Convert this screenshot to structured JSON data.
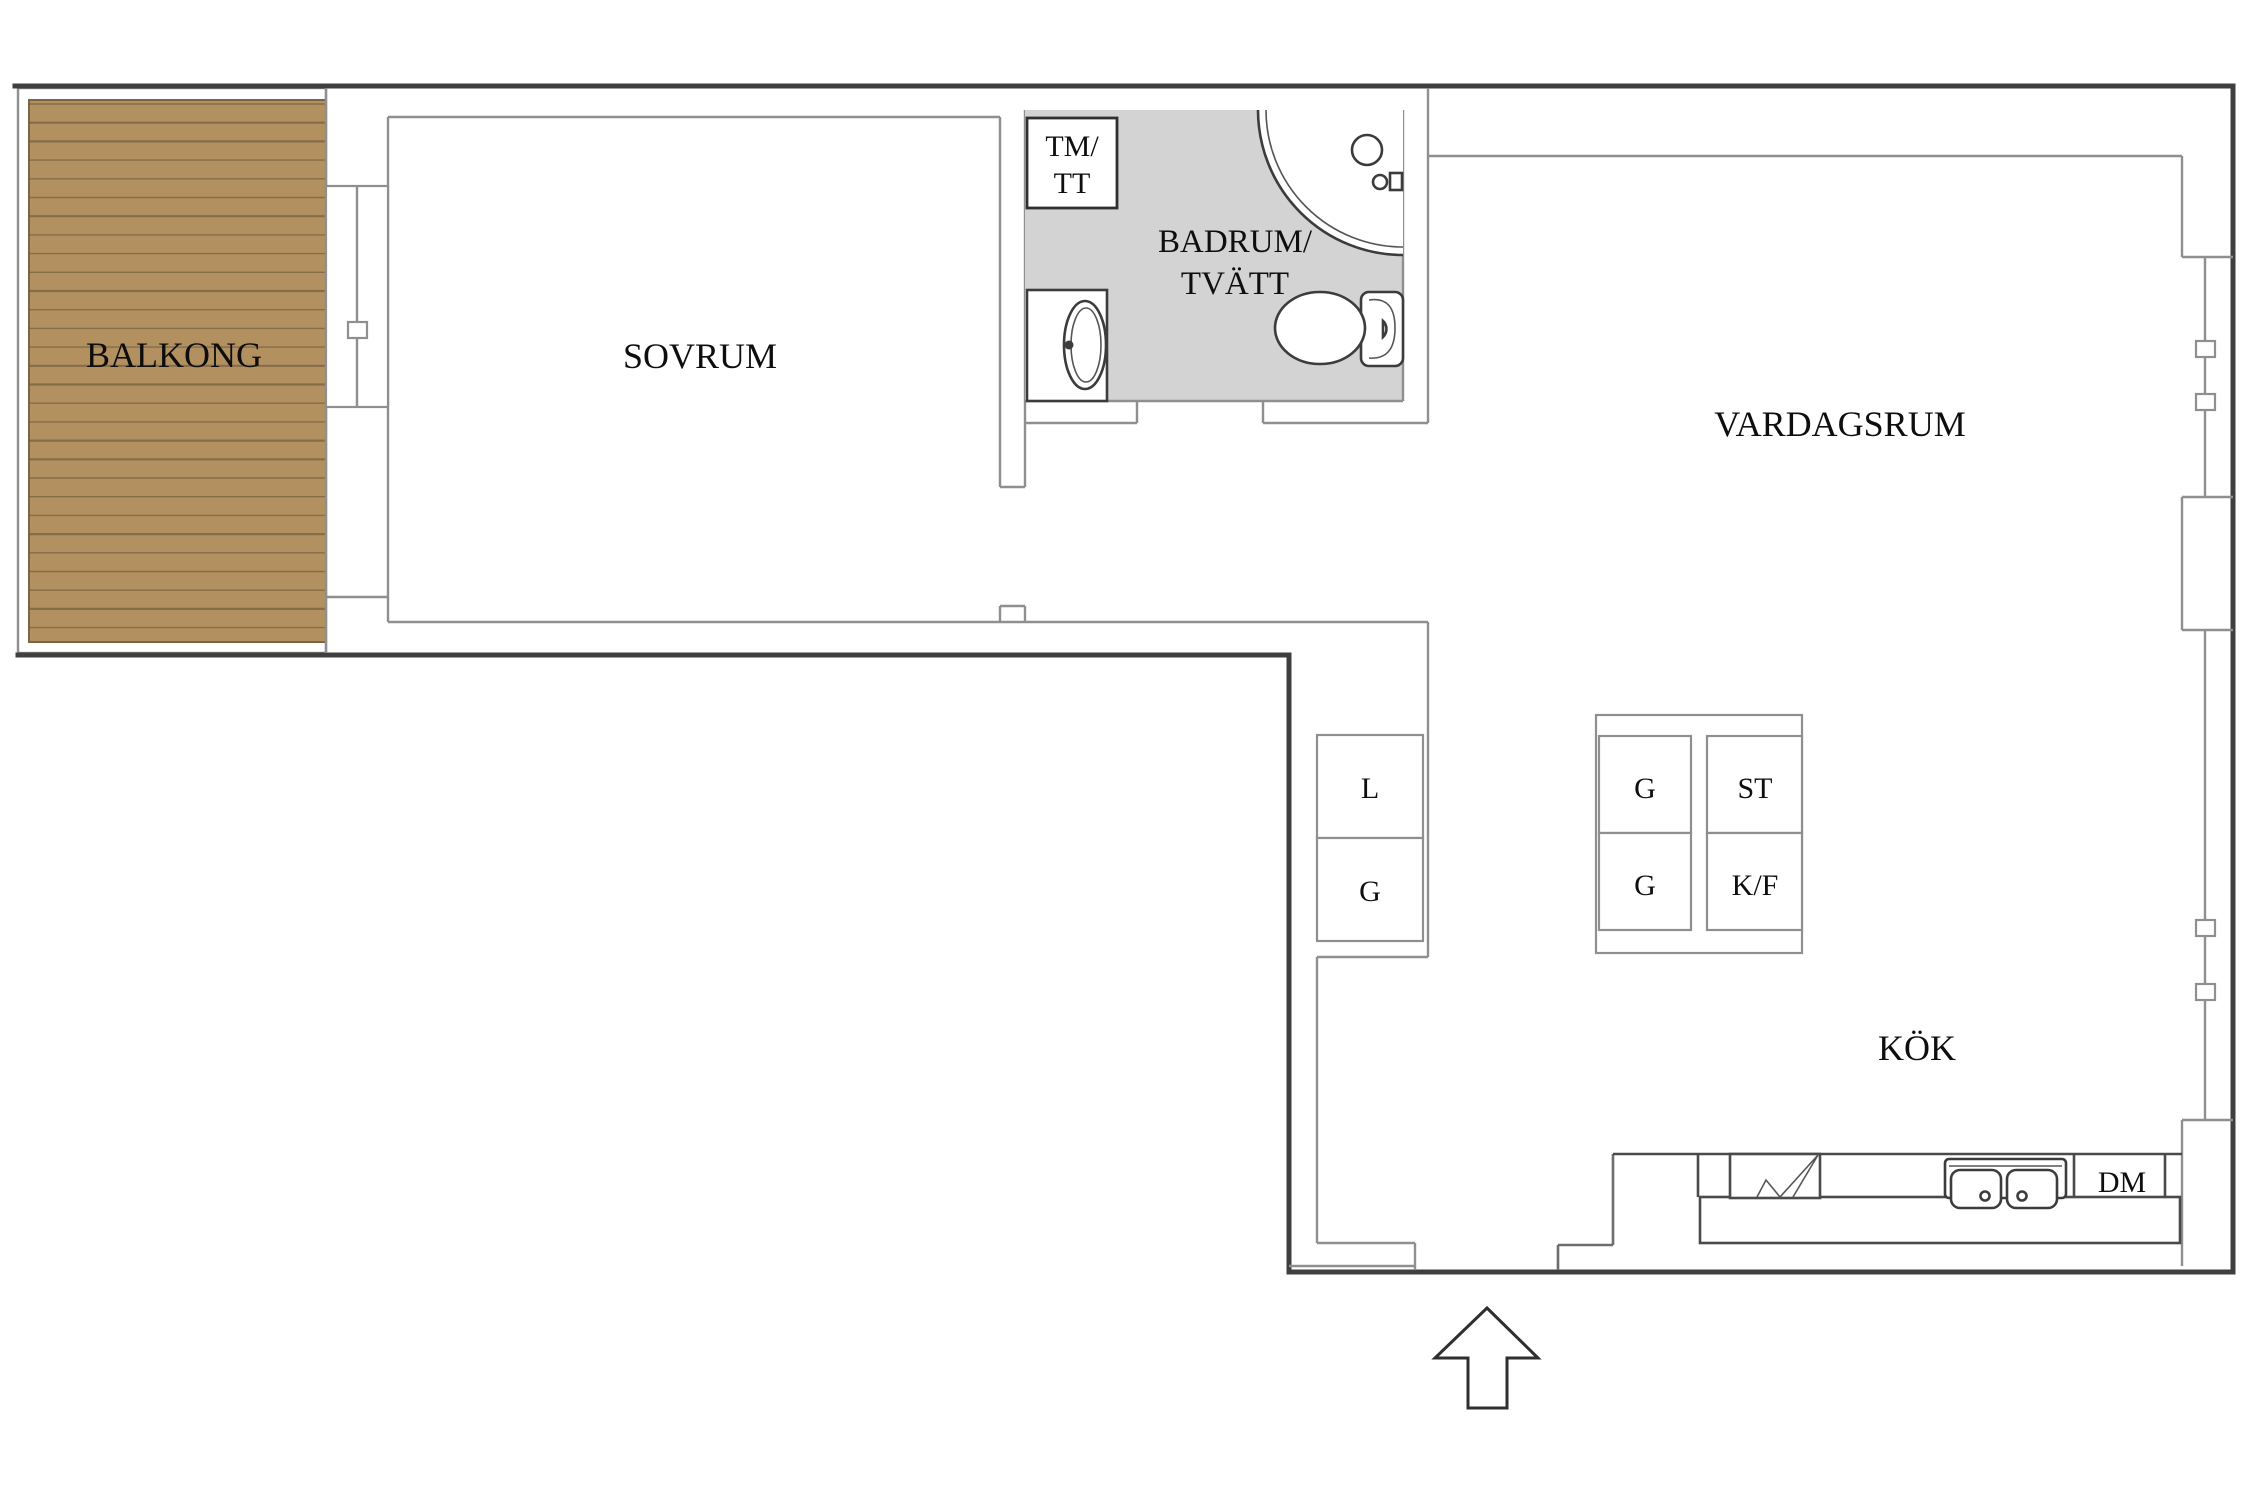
{
  "labels": {
    "balcony": "BALKONG",
    "bedroom": "SOVRUM",
    "bathroom_line1": "BADRUM/",
    "bathroom_line2": "TVÄTT",
    "living_room": "VARDAGSRUM",
    "kitchen": "KÖK",
    "washer_line1": "TM/",
    "washer_line2": "TT",
    "hall_closet_top": "L",
    "hall_closet_bottom": "G",
    "unit_top_left": "G",
    "unit_top_right": "ST",
    "unit_bottom_left": "G",
    "unit_bottom_right": "K/F",
    "dishwasher": "DM"
  },
  "colors": {
    "wood": "#b3905f",
    "wood_line": "#6f5a3e",
    "bathroom_floor": "#d3d3d3",
    "wall_dark": "#3f3f3f",
    "wall_light": "#8f8f8f",
    "background": "#ffffff"
  }
}
